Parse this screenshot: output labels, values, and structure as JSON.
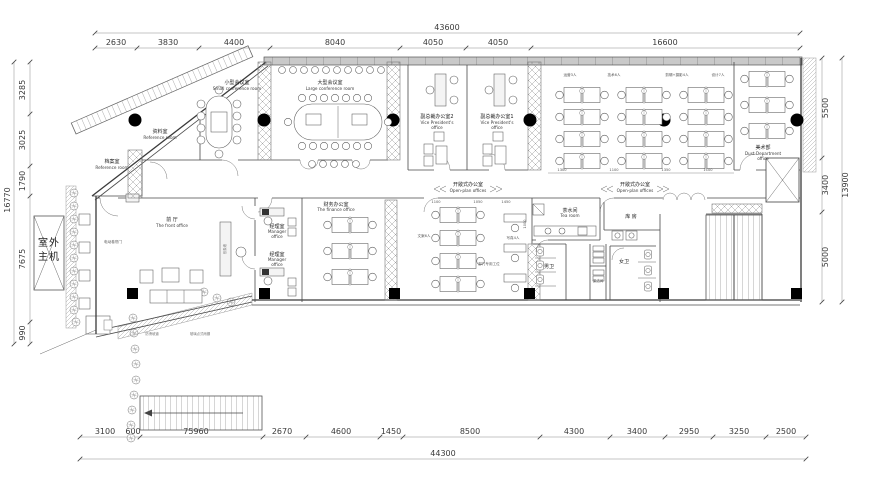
{
  "dims": {
    "top_total": "43600",
    "ts": [
      "2630",
      "3830",
      "4400",
      "8040",
      "4050",
      "4050",
      "16600"
    ],
    "bottom_total": "44300",
    "bs": [
      "3100",
      "600",
      "75960",
      "2670",
      "4600",
      "1450",
      "8500",
      "4300",
      "3400",
      "2950",
      "3250",
      "2500"
    ],
    "left_total": "16770",
    "ls": [
      "3285",
      "3025",
      "1790",
      "7675",
      "990"
    ],
    "right_total": "13900",
    "rs": [
      "5500",
      "3400",
      "5000"
    ],
    "md": {
      "a": "1300",
      "b": "1100",
      "c": "1350",
      "d": "1100",
      "e": "1100",
      "f": "1050",
      "g": "1450",
      "h": "1000"
    }
  },
  "rooms": {
    "archive": {
      "cn": "档案室",
      "en": "Reference room"
    },
    "reference": {
      "cn": "资料室",
      "en": "Reference room"
    },
    "small_conf": {
      "cn": "小型会议室",
      "en": "Small conference room"
    },
    "large_conf": {
      "cn": "大型会议室",
      "en": "Large conference room"
    },
    "vp2": {
      "cn": "副总裁办公室2",
      "en1": "Vice President's",
      "en2": "office"
    },
    "vp1": {
      "cn": "副总裁办公室1",
      "en1": "Vice President's",
      "en2": "office"
    },
    "art": {
      "cn": "美术部",
      "en1": "Dust Department",
      "en2": "office"
    },
    "open": {
      "cn": "开敞式办公室",
      "en": "Open-plan offices"
    },
    "front": {
      "cn": "前 厅",
      "en": "The front office"
    },
    "finance": {
      "cn": "财务办公室",
      "en": "The finance office"
    },
    "manager": {
      "cn": "经理室",
      "en1": "Manager",
      "en2": "office"
    },
    "tea": {
      "cn": "茶水间",
      "en": "Tea room"
    },
    "storage": {
      "cn": "库 房"
    },
    "male_wc": {
      "cn": "男卫"
    },
    "female_wc": {
      "cn": "女卫"
    },
    "cleaning": {
      "cn": "保洁间"
    },
    "outdoor": {
      "l1": "室外",
      "l2": "主机"
    }
  },
  "teams": [
    "运营3人",
    "技术6人",
    "剪辑+摄影4人",
    "设计7人"
  ],
  "mid_teams": [
    "文案6人",
    "写真4人",
    "部门专用工位"
  ],
  "notes": {
    "door": "电动卷帘门",
    "wall": "形象墙",
    "ramp": "防滑坡道",
    "canopy": "玻璃点式雨棚"
  }
}
